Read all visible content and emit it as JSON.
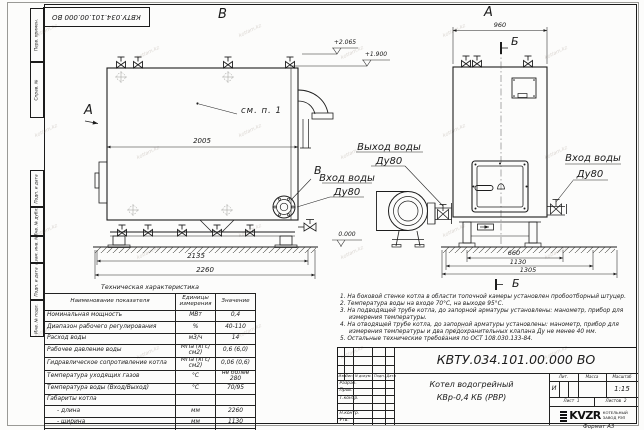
{
  "doc_number": "КВТУ.034.101.00.000  ВО",
  "frame": {
    "left_stamps": [
      "Перв. примен.",
      "Справ. №",
      "Подп. и дата",
      "Инв. № дубл.",
      "Взам. инв. №",
      "Подп. и дата",
      "Инв. № подл."
    ]
  },
  "views": {
    "side_view_label": "В",
    "front_view_label": "А",
    "cut_label": "Б",
    "section_label": "Б",
    "view_arrow_label": "А",
    "flange_ref_label": "В",
    "see_note_ref": "см. п. 1",
    "elev_top": "+2.065",
    "elev_mid": "+1.900",
    "elev_zero": "0.000",
    "dim_2005": "2005",
    "dim_2135": "2135",
    "dim_2260": "2260",
    "dim_960": "960",
    "dim_660": "660",
    "dim_1130": "1130",
    "dim_1305": "1305",
    "outlet_line1": "Выход воды",
    "outlet_line2": "Ду80",
    "inlet_left_line1": "Вход воды",
    "inlet_left_line2": "Ду80",
    "inlet_right_line1": "Вход воды",
    "inlet_right_line2": "Ду80"
  },
  "table": {
    "title": "Техническая характеристика",
    "headers": [
      "Наименование показателя",
      "Единицы измерения",
      "Значение"
    ],
    "rows": [
      {
        "name": "Номинальная мощность",
        "unit": "МВт",
        "value": "0,4"
      },
      {
        "name": "Диапазон рабочего регулирования",
        "unit": "%",
        "value": "40-110"
      },
      {
        "name": "Расход воды",
        "unit": "м3/ч",
        "value": "14"
      },
      {
        "name": "Рабочее давление воды",
        "unit": "МПа (кгс/см2)",
        "value": "0,6 (6,0)"
      },
      {
        "name": "Гидравлическое сопротивление котла",
        "unit": "МПа (кгс/см2)",
        "value": "0,06 (0,6)"
      },
      {
        "name": "Температура уходящих газов",
        "unit": "°С",
        "value": "не более 280"
      },
      {
        "name": "Температура воды (Вход/Выход)",
        "unit": "°С",
        "value": "70/95"
      },
      {
        "name": "Габариты котла",
        "unit": "",
        "value": ""
      },
      {
        "name": "- длина",
        "unit": "мм",
        "value": "2260"
      },
      {
        "name": "- ширина",
        "unit": "мм",
        "value": "1130"
      },
      {
        "name": "- высота",
        "unit": "мм",
        "value": "1950"
      }
    ]
  },
  "notes": [
    "1. На боковой стенке котла в области топочной камеры установлен пробоотборный штуцер.",
    "2. Температура воды на входе 70°С, на выходе 95°С.",
    "3. На подводящей трубе котла, до запорной арматуры установлены: манометр, прибор для измерения температуры.",
    "4. На отводящей трубе котла, до запорной арматуры установлены: манометр, прибор для измерения температуры и два предохранительных клапана Ду не менее 40 мм.",
    "5. Остальные технические требования по ОСТ 108.030.133-84."
  ],
  "title_block": {
    "header_cols": [
      "Изм.",
      "Лист",
      "N докум.",
      "Подп.",
      "Дата"
    ],
    "sig_rows": [
      "Разраб.",
      "Пров.",
      "Т.контр.",
      "",
      "Н.контр.",
      "Утв."
    ],
    "lit_label": "Лит.",
    "mass_label": "Масса",
    "scale_label": "Масштаб",
    "lit_value": "И",
    "scale_value": "1:15",
    "sheet_label": "Лист",
    "sheet_number": "1",
    "sheets_label": "Листов",
    "sheets_total": "2",
    "product_name_line1": "Котел водогрейный",
    "product_name_line2": "КВр-0,4  КБ  (РВР)",
    "logo_text": "KVZR",
    "logo_sub1": "КОТЕЛЬНЫЙ",
    "logo_sub2": "ЗАВОД РЭП",
    "format_label": "Формат  А3"
  },
  "watermark": "kotlam.kz"
}
